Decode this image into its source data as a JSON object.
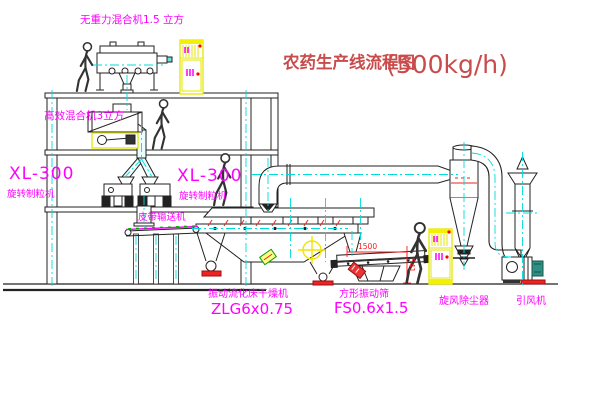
{
  "title": {
    "name": "农药生产线流程图",
    "capacity": "(500kg/h)"
  },
  "equipment": {
    "gravity_free_mixer": "无重力混合机1.5 立方",
    "high_efficiency_mixer": "高效混合机3立方",
    "granulator_left": {
      "model": "XL-300",
      "name": "旋转制粒机"
    },
    "granulator_center": {
      "model": "XL-300",
      "name": "旋转制粒机"
    },
    "belt_conveyor": "皮带输送机",
    "fluid_bed_dryer": {
      "name": "振动流化床干燥机",
      "model": "ZLG6x0.75"
    },
    "square_vibrating_sieve": {
      "name": "方形振动筛",
      "model": "FS0.6x1.5"
    },
    "cyclone_dust_collector": "旋风除尘器",
    "induced_draft_fan": "引风机"
  },
  "dimensions": {
    "sieve_length": "1500",
    "sieve_height": "541"
  },
  "colors": {
    "label_magenta": "#ff00ff",
    "title_red": "#c94b4b",
    "dimension_red": "#ff1a1a",
    "centerline_cyan": "#00dcdc",
    "cabinet_yellow": "#f2f200",
    "line_dark": "#222222"
  }
}
